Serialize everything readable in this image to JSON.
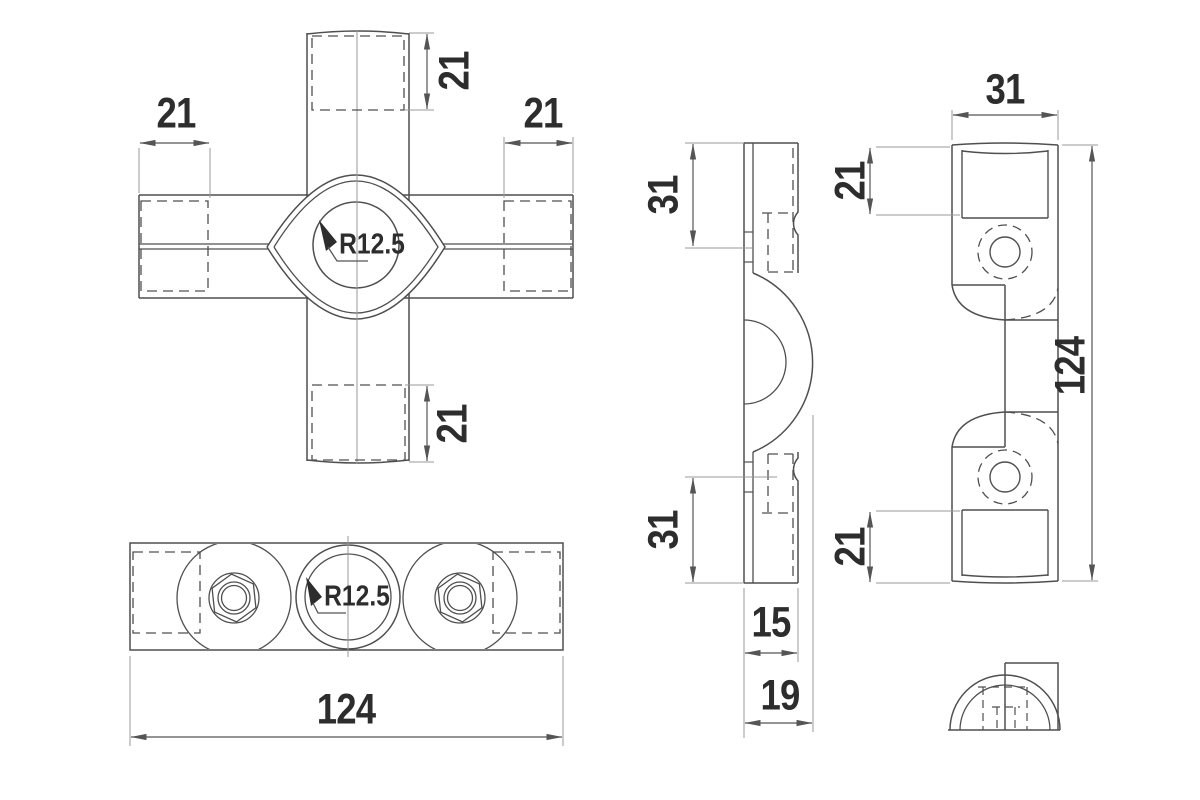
{
  "drawing": {
    "colors": {
      "background": "#ffffff",
      "outline": "#4f4f4f",
      "thin_line": "#9a9a9a",
      "dimension_line": "#555555",
      "text": "#2d2d2d"
    },
    "front_view": {
      "dims": {
        "top": "21",
        "left": "21",
        "right": "21",
        "bottom": "21"
      },
      "radius": "R12.5"
    },
    "bottom_view": {
      "radius": "R12.5",
      "width": "124"
    },
    "profile_view": {
      "top": "31",
      "bottom": "31",
      "thickness": "15",
      "depth": "19"
    },
    "side_view": {
      "width": "31",
      "top": "21",
      "bottom": "21",
      "height": "124"
    }
  }
}
